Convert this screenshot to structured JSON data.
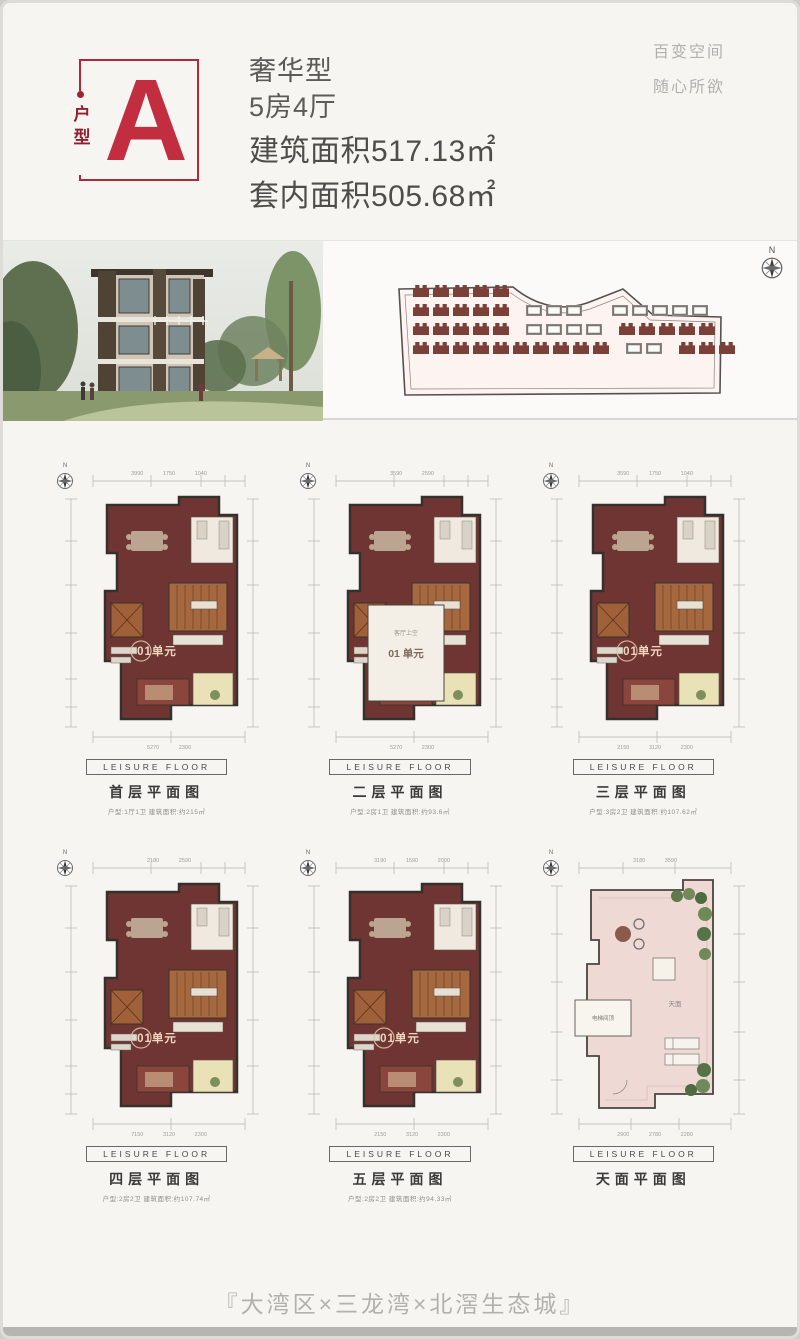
{
  "header": {
    "badge": {
      "letter": "A",
      "vertical_label": "户型"
    },
    "type_label": "奢华型",
    "rooms": "5房4厅",
    "build_area": "建筑面积517.13㎡",
    "inner_area": "套内面积505.68㎡",
    "slogan_line1": "百变空间",
    "slogan_line2": "随心所欲"
  },
  "site_plan": {
    "compass_label": "N",
    "rows": [
      "11111",
      "11111 000  00000",
      "11111 0000 11111",
      "1111111111 00 111"
    ],
    "house_color": "#7b4038"
  },
  "plans": [
    {
      "tag": "LEISURE FLOOR",
      "title": "首层平面图",
      "info": "户型:1厅1卫  建筑面积:约215㎡",
      "unit_label": "01单元",
      "compass": "N",
      "top_dims": "3990 1750 1040",
      "bottom_dims": "5270 2300"
    },
    {
      "tag": "LEISURE FLOOR",
      "title": "二层平面图",
      "info": "户型:2房1卫  建筑面积:约93.6㎡",
      "unit_label": "01 单元",
      "void_label": "客厅上空",
      "compass": "N",
      "top_dims": "3590 2590",
      "bottom_dims": "5270 2300"
    },
    {
      "tag": "LEISURE FLOOR",
      "title": "三层平面图",
      "info": "户型:3房2卫  建筑面积:约107.62㎡",
      "unit_label": "01单元",
      "compass": "N",
      "top_dims": "3590 1750 1040",
      "bottom_dims": "2150 3120 2300"
    },
    {
      "tag": "LEISURE FLOOR",
      "title": "四层平面图",
      "info": "户型:2房2卫  建筑面积:约107.74㎡",
      "unit_label": "01单元",
      "compass": "N",
      "top_dims": "2180 2590",
      "bottom_dims": "7150 3120 2300"
    },
    {
      "tag": "LEISURE FLOOR",
      "title": "五层平面图",
      "info": "户型:2房2卫  建筑面积:约94.33㎡",
      "unit_label": "01单元",
      "compass": "N",
      "top_dims": "3190 1590 2000",
      "bottom_dims": "2150 3120 2300"
    },
    {
      "tag": "LEISURE FLOOR",
      "title": "天面平面图",
      "info": "",
      "unit_label": "",
      "roof_label": "天面",
      "elevator_label": "电梯间顶",
      "compass": "N",
      "top_dims": "3180 3590",
      "bottom_dims": "2900 2780 2280"
    }
  ],
  "footer": {
    "tagline": "『大湾区×三龙湾×北滘生态城』"
  },
  "colors": {
    "accent_red": "#c0293a",
    "badge_text_red": "#8f2030",
    "plan_maroon": "#6f3532",
    "stair_brown": "#a5683f",
    "roof_pink": "#eed9d4",
    "house_red": "#7b4038"
  }
}
